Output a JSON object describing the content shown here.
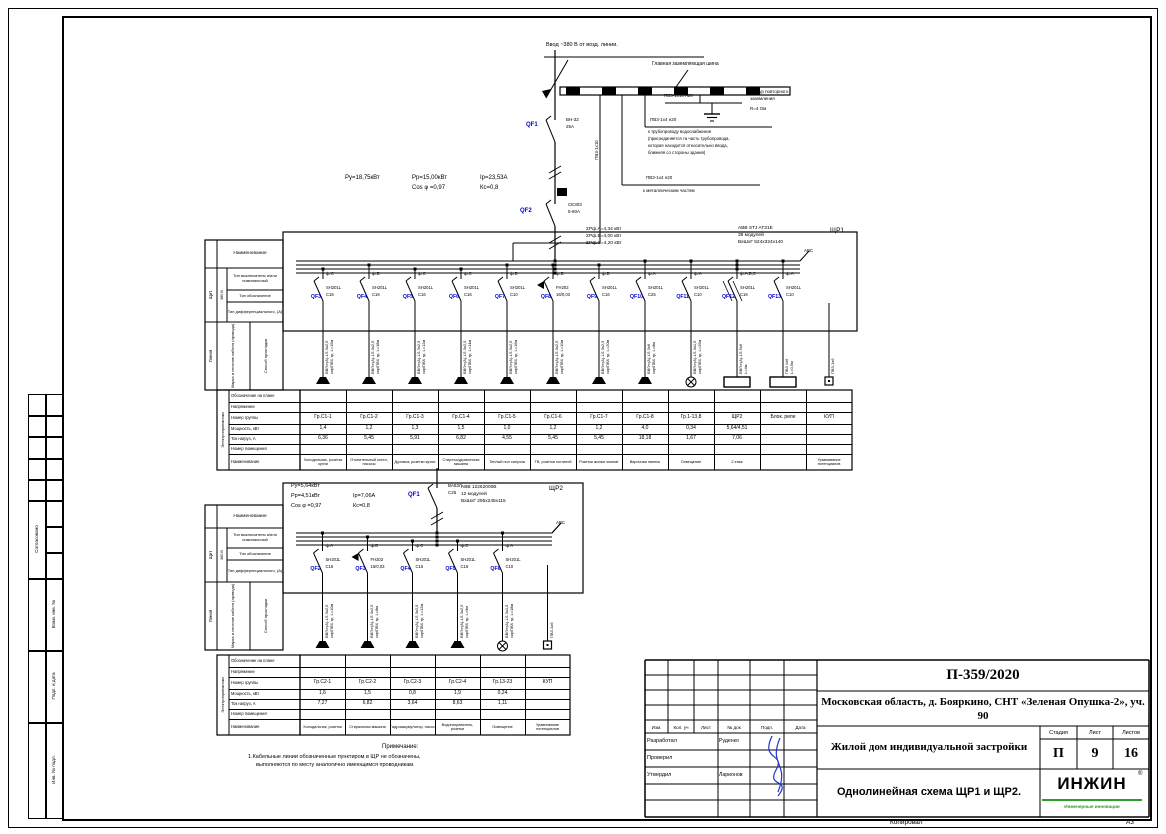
{
  "colors": {
    "wire_black": "#000000",
    "qf_blue": "#0000cc",
    "logo_green": "#2f9e2f",
    "signature_blue": "#2233cc"
  },
  "frame": {
    "kopiroval": "Копировал",
    "format": "А3"
  },
  "side": {
    "agreed": "Согласовано",
    "vzam": "Взам. инв. №",
    "podp": "Подп. и дата",
    "inv": "Инв. № подл."
  },
  "stamp": {
    "doc": "П-359/2020",
    "object": "Московская область, д. Бояркино, СНТ «Зеленая Опушка-2», уч. 90",
    "building": "Жилой дом индивидуальной застройки",
    "sheet_title": "Однолинейная схема ЩР1 и ЩР2.",
    "stage_label": "Стадия",
    "list_label": "Лист",
    "lists_label": "Листов",
    "stage": "П",
    "list": "9",
    "lists": "16",
    "cols": [
      "Изм.",
      "Кол. уч",
      "Лист",
      "№ док",
      "Подп.",
      "Дата"
    ],
    "rows": [
      {
        "role": "Разработал",
        "name": "Руденко"
      },
      {
        "role": "Проверил",
        "name": ""
      },
      {
        "role": "Утвердил",
        "name": "Ларионов"
      }
    ],
    "logo_name": "ИНЖИН",
    "logo_reg": "®",
    "logo_tagline": "Инженерные инновации"
  },
  "input": {
    "feed": "Ввод ~380 В от возд. линии.",
    "gzsh": "Главная заземляющая шина",
    "pe_riser": "ПВ3-1х10",
    "ground_label": "ПВ3-1х10 н20",
    "ground_note": [
      "контур повторного",
      "заземления",
      "R=4 Ом"
    ],
    "water_label": "ПВ3-1х4 н20",
    "water_note": [
      "к трубопроводу водоснабжения",
      "(присоединяется та часть трубопровода,",
      "которая находится относительно ввода,",
      "ближняя со стороны здания)"
    ],
    "metal_label": "ПВ3-1х4 н20",
    "metal_note": "к металлическим частям",
    "qf1": {
      "id": "QF1",
      "t1": "ВН-32",
      "t2": "25А"
    },
    "qf2": {
      "id": "QF2",
      "t1": "СЕ303",
      "t2": "5-60А"
    }
  },
  "table": {
    "naim": "Наименование",
    "shield": "Щит",
    "volt": "380 В",
    "r1": "Тип выключателя и/или номинальный",
    "r2": "Тип обозначение",
    "r3": "Тип дифференциального, (А)",
    "line": "Линия",
    "cable": "Марка и сечение кабеля (провода)",
    "way": "Способ прокладки",
    "ep": "Электроприемники",
    "rows": [
      "Обозначение на плане",
      "Напряжение",
      "Номер группы",
      "Мощность, кВт",
      "Ток нагруз, А",
      "Номер помещения",
      "Наименование"
    ]
  },
  "panel1": {
    "name": "ЩР1",
    "bus_mark": "АВС",
    "power": {
      "pu": "Ру=18,75кВт",
      "pp": "Рр=15,00кВт",
      "ip": "Iр=23,53А",
      "cos": "Cos φ =0,97",
      "ks": "Кс=0,8"
    },
    "sums": [
      "ΣРф.А=4,34 кВт",
      "ΣРф.В=4,00 кВт",
      "ΣРф.С=4,20 кВт"
    ],
    "model": [
      "ABB STJ AT31E",
      "36 модулей",
      "ВхШхГ 524х324х140"
    ],
    "groups": [
      {
        "ph": "ф.С",
        "qf": "QF3",
        "t1": "SH201L",
        "t2": "С16",
        "c1": "ВВГнг(А)-LS 3х2,5",
        "c2": "скр/ПВХ тр, L=15м",
        "sym": "socket",
        "grp": "Гр.С1-1",
        "pw": "1,4",
        "cur": "6,36",
        "nm": "Холодильник, розетки кухни",
        "diff": false,
        "tri": false
      },
      {
        "ph": "ф.В",
        "qf": "QF4",
        "t1": "SH201L",
        "t2": "С16",
        "c1": "ВВГнг(А)-LS 3х2,5",
        "c2": "скр/ПВХ тр, L=18м",
        "sym": "socket",
        "grp": "Гр.С1-2",
        "pw": "1,2",
        "cur": "5,45",
        "nm": "Отопительный котел, насосы",
        "diff": false,
        "tri": false
      },
      {
        "ph": "ф.С",
        "qf": "QF5",
        "t1": "SH201L",
        "t2": "С16",
        "c1": "ВВГнг(А)-LS 3х2,5",
        "c2": "скр/ПВХ тр, L=12м",
        "sym": "socket",
        "grp": "Гр.С1-3",
        "pw": "1,3",
        "cur": "5,91",
        "nm": "Духовка, розетки кухни",
        "diff": false,
        "tri": false
      },
      {
        "ph": "ф.С",
        "qf": "QF6",
        "t1": "SH201L",
        "t2": "С16",
        "c1": "ВВГнг(А)-LS 3х2,5",
        "c2": "скр/ПВХ тр, L=14м",
        "sym": "socket",
        "grp": "Гр.С1-4",
        "pw": "1,5",
        "cur": "6,82",
        "nm": "Стир/посудомоечная машина",
        "diff": false,
        "tri": false
      },
      {
        "ph": "ф.В",
        "qf": "QF7",
        "t1": "SH201L",
        "t2": "С10",
        "c1": "ВВГнг(А)-LS 3х2,5",
        "c2": "скр/ПВХ тр, L=16м",
        "sym": "socket",
        "grp": "Гр.С1-5",
        "pw": "1,0",
        "cur": "4,55",
        "nm": "Теплый пол санузла",
        "diff": false,
        "tri": false
      },
      {
        "ph": "ф.В",
        "qf": "QF8",
        "t1": "FH202",
        "t2": "16/0,03",
        "c1": "ВВГнг(А)-LS 3х2,5",
        "c2": "скр/ПВХ тр, L=10м",
        "sym": "socket",
        "grp": "Гр.С1-6",
        "pw": "1,2",
        "cur": "5,45",
        "nm": "ТВ, розетки гостиной",
        "diff": true,
        "tri": false
      },
      {
        "ph": "ф.В",
        "qf": "QF9",
        "t1": "SH201L",
        "t2": "С16",
        "c1": "ВВГнг(А)-LS 3х2,5",
        "c2": "скр/ПВХ тр, L=20м",
        "sym": "socket",
        "grp": "Гр.С1-7",
        "pw": "1,2",
        "cur": "5,45",
        "nm": "Розетки жилых комнат",
        "diff": false,
        "tri": false
      },
      {
        "ph": "ф.А",
        "qf": "QF10",
        "t1": "SH201L",
        "t2": "С25",
        "c1": "ВВГнг(А)-LS 3х6",
        "c2": "скр/ПВХ тр, L=8м",
        "sym": "socket",
        "grp": "Гр.С1-8",
        "pw": "4,0",
        "cur": "18,18",
        "nm": "Варочная панель",
        "diff": false,
        "tri": false
      },
      {
        "ph": "ф.А",
        "qf": "QF11",
        "t1": "SH201L",
        "t2": "С10",
        "c1": "ВВГнг(А)-LS 3х1,5",
        "c2": "скр/ПВХ тр, L=25м",
        "sym": "lamp",
        "grp": "Гр.1-13,8",
        "pw": "0,34",
        "cur": "1,67",
        "nm": "Освещение",
        "diff": false,
        "tri": false
      },
      {
        "ph": "ф.А,В,С",
        "qf": "QF12",
        "t1": "SH201L",
        "t2": "С16",
        "c1": "ВВГнг(А)-LS 5х6",
        "c2": "L=4м",
        "sym": "box",
        "grp": "ЩР2",
        "pw": "5,64/4,51",
        "cur": "7,06",
        "nm": "2 этаж",
        "diff": false,
        "tri": true
      },
      {
        "ph": "ф.А",
        "qf": "QF13",
        "t1": "SH201L",
        "t2": "С10",
        "c1": "ПВ3 1х6",
        "c2": "L=0,5м",
        "sym": "box",
        "grp": "Блок. реле",
        "pw": "",
        "cur": "",
        "nm": "",
        "diff": false,
        "tri": false
      },
      {
        "ph": "",
        "qf": "",
        "t1": "",
        "t2": "",
        "c1": "ПВ3-1х6",
        "c2": "",
        "sym": "square",
        "grp": "КУП",
        "pw": "",
        "cur": "",
        "nm": "Уравнивание потенциалов",
        "diff": false,
        "tri": false
      }
    ]
  },
  "panel2": {
    "name": "ЩР2",
    "bus_mark": "АВС",
    "power": {
      "pu": "Ру=5,64кВт",
      "pp": "Рр=4,51кВт",
      "ip": "Iр=7,06А",
      "cos": "Cos φ =0,97",
      "ks": "Кс=0,8"
    },
    "model": [
      "ABB 12262000В",
      "12 модулей",
      "ВхШхГ 295х245х115"
    ],
    "qf1": {
      "id": "QF1",
      "t1": "ВА63Л",
      "t2": "С25"
    },
    "groups": [
      {
        "ph": "ф.А",
        "qf": "QF2",
        "t1": "SH201L",
        "t2": "С16",
        "c1": "ВВГнг(А)-LS 3х2,5",
        "c2": "скр/ПВХ тр, L=10м",
        "sym": "socket",
        "grp": "Гр.С2-1",
        "pw": "1,6",
        "cur": "7,27",
        "nm": "Холодильник, розетки",
        "diff": false,
        "tri": false
      },
      {
        "ph": "ф.В",
        "qf": "QF3",
        "t1": "FH202",
        "t2": "16/0,03",
        "c1": "ВВГнг(А)-LS 3х2,5",
        "c2": "скр/ПВХ тр, L=8м",
        "sym": "socket",
        "grp": "Гр.С2-2",
        "pw": "1,5",
        "cur": "6,82",
        "nm": "Стиральная машина",
        "diff": true,
        "tri": false
      },
      {
        "ph": "ф.С",
        "qf": "QF4",
        "t1": "SH201L",
        "t2": "С16",
        "c1": "ВВГнг(А)-LS 3х2,5",
        "c2": "скр/ПВХ тр, L=12м",
        "sym": "socket",
        "grp": "Гр.С2-3",
        "pw": "0,8",
        "cur": "3,64",
        "nm": "Гидроаккумулятор, насос",
        "diff": false,
        "tri": false
      },
      {
        "ph": "ф.С",
        "qf": "QF5",
        "t1": "SH201L",
        "t2": "С16",
        "c1": "ВВГнг(А)-LS 3х2,5",
        "c2": "скр/ПВХ тр, L=9м",
        "sym": "socket",
        "grp": "Гр.С2-4",
        "pw": "1,9",
        "cur": "8,63",
        "nm": "Водонагреватель, розетки",
        "diff": false,
        "tri": false
      },
      {
        "ph": "ф.А",
        "qf": "QF6",
        "t1": "SH201L",
        "t2": "С10",
        "c1": "ВВГнг(А)-LS 3х1,5",
        "c2": "скр/ПВХ тр, L=18м",
        "sym": "lamp",
        "grp": "Гр.13-23",
        "pw": "0,24",
        "cur": "1,11",
        "nm": "Освещение",
        "diff": false,
        "tri": false
      },
      {
        "ph": "",
        "qf": "",
        "t1": "",
        "t2": "",
        "c1": "ПВ3-1х6",
        "c2": "",
        "sym": "square",
        "grp": "КУП",
        "pw": "",
        "cur": "",
        "nm": "Уравнивание потенциалов",
        "diff": false,
        "tri": false
      }
    ]
  },
  "note": {
    "title": "Примечание:",
    "lines": [
      "1.Кабельные линии обозначенные пунктиром в ЩР не обозначены,",
      "выполняются по месту аналогично имеющимся проводникам."
    ]
  }
}
